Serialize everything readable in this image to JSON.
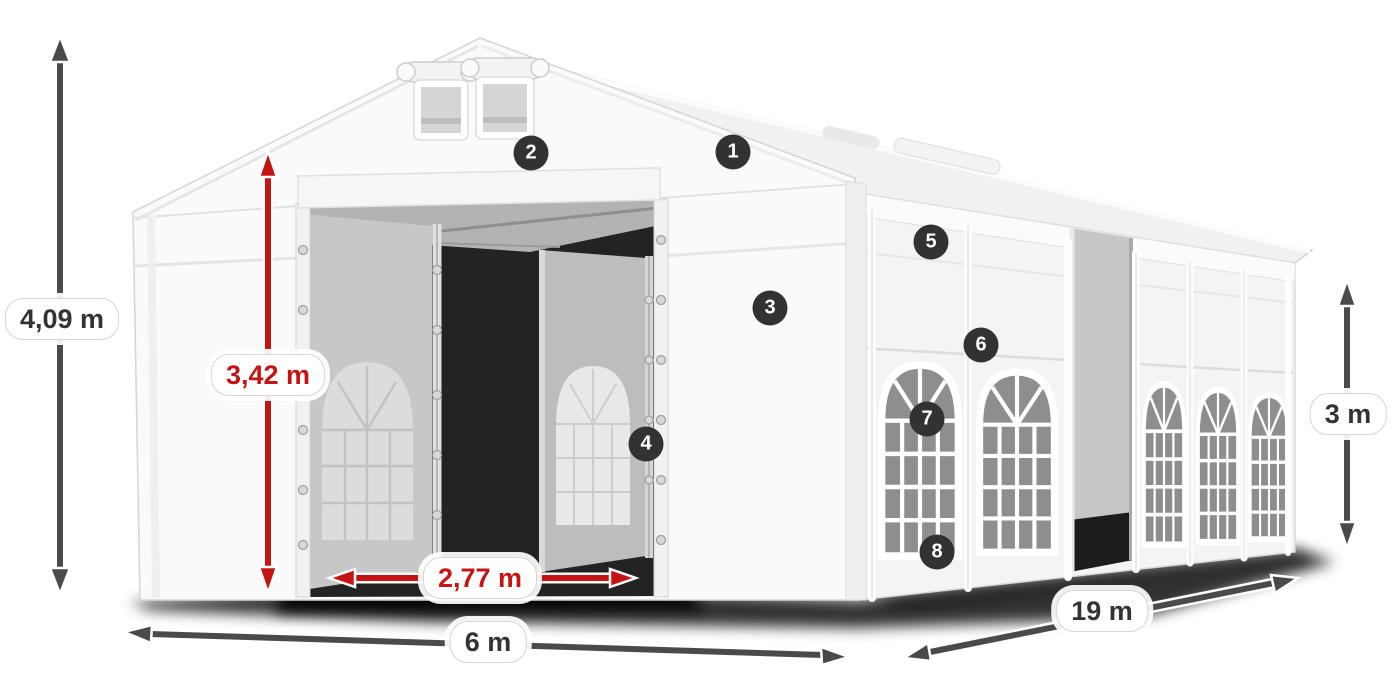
{
  "diagram": {
    "dimensions": {
      "total_height": "4,09 m",
      "entrance_height": "3,42 m",
      "entrance_width": "2,77 m",
      "front_width": "6 m",
      "side_length": "19 m",
      "side_wall_height": "3 m"
    },
    "markers": [
      {
        "label": "1"
      },
      {
        "label": "2"
      },
      {
        "label": "3"
      },
      {
        "label": "4"
      },
      {
        "label": "5"
      },
      {
        "label": "6"
      },
      {
        "label": "7"
      },
      {
        "label": "8"
      }
    ],
    "colors": {
      "dark_arrow": "#4a4a4a",
      "red_arrow": "#c51414",
      "marker_background": "#323232",
      "marker_text": "#ffffff",
      "label_background": "#ffffff",
      "label_text_dark": "#333333",
      "label_text_red": "#c51414"
    }
  }
}
